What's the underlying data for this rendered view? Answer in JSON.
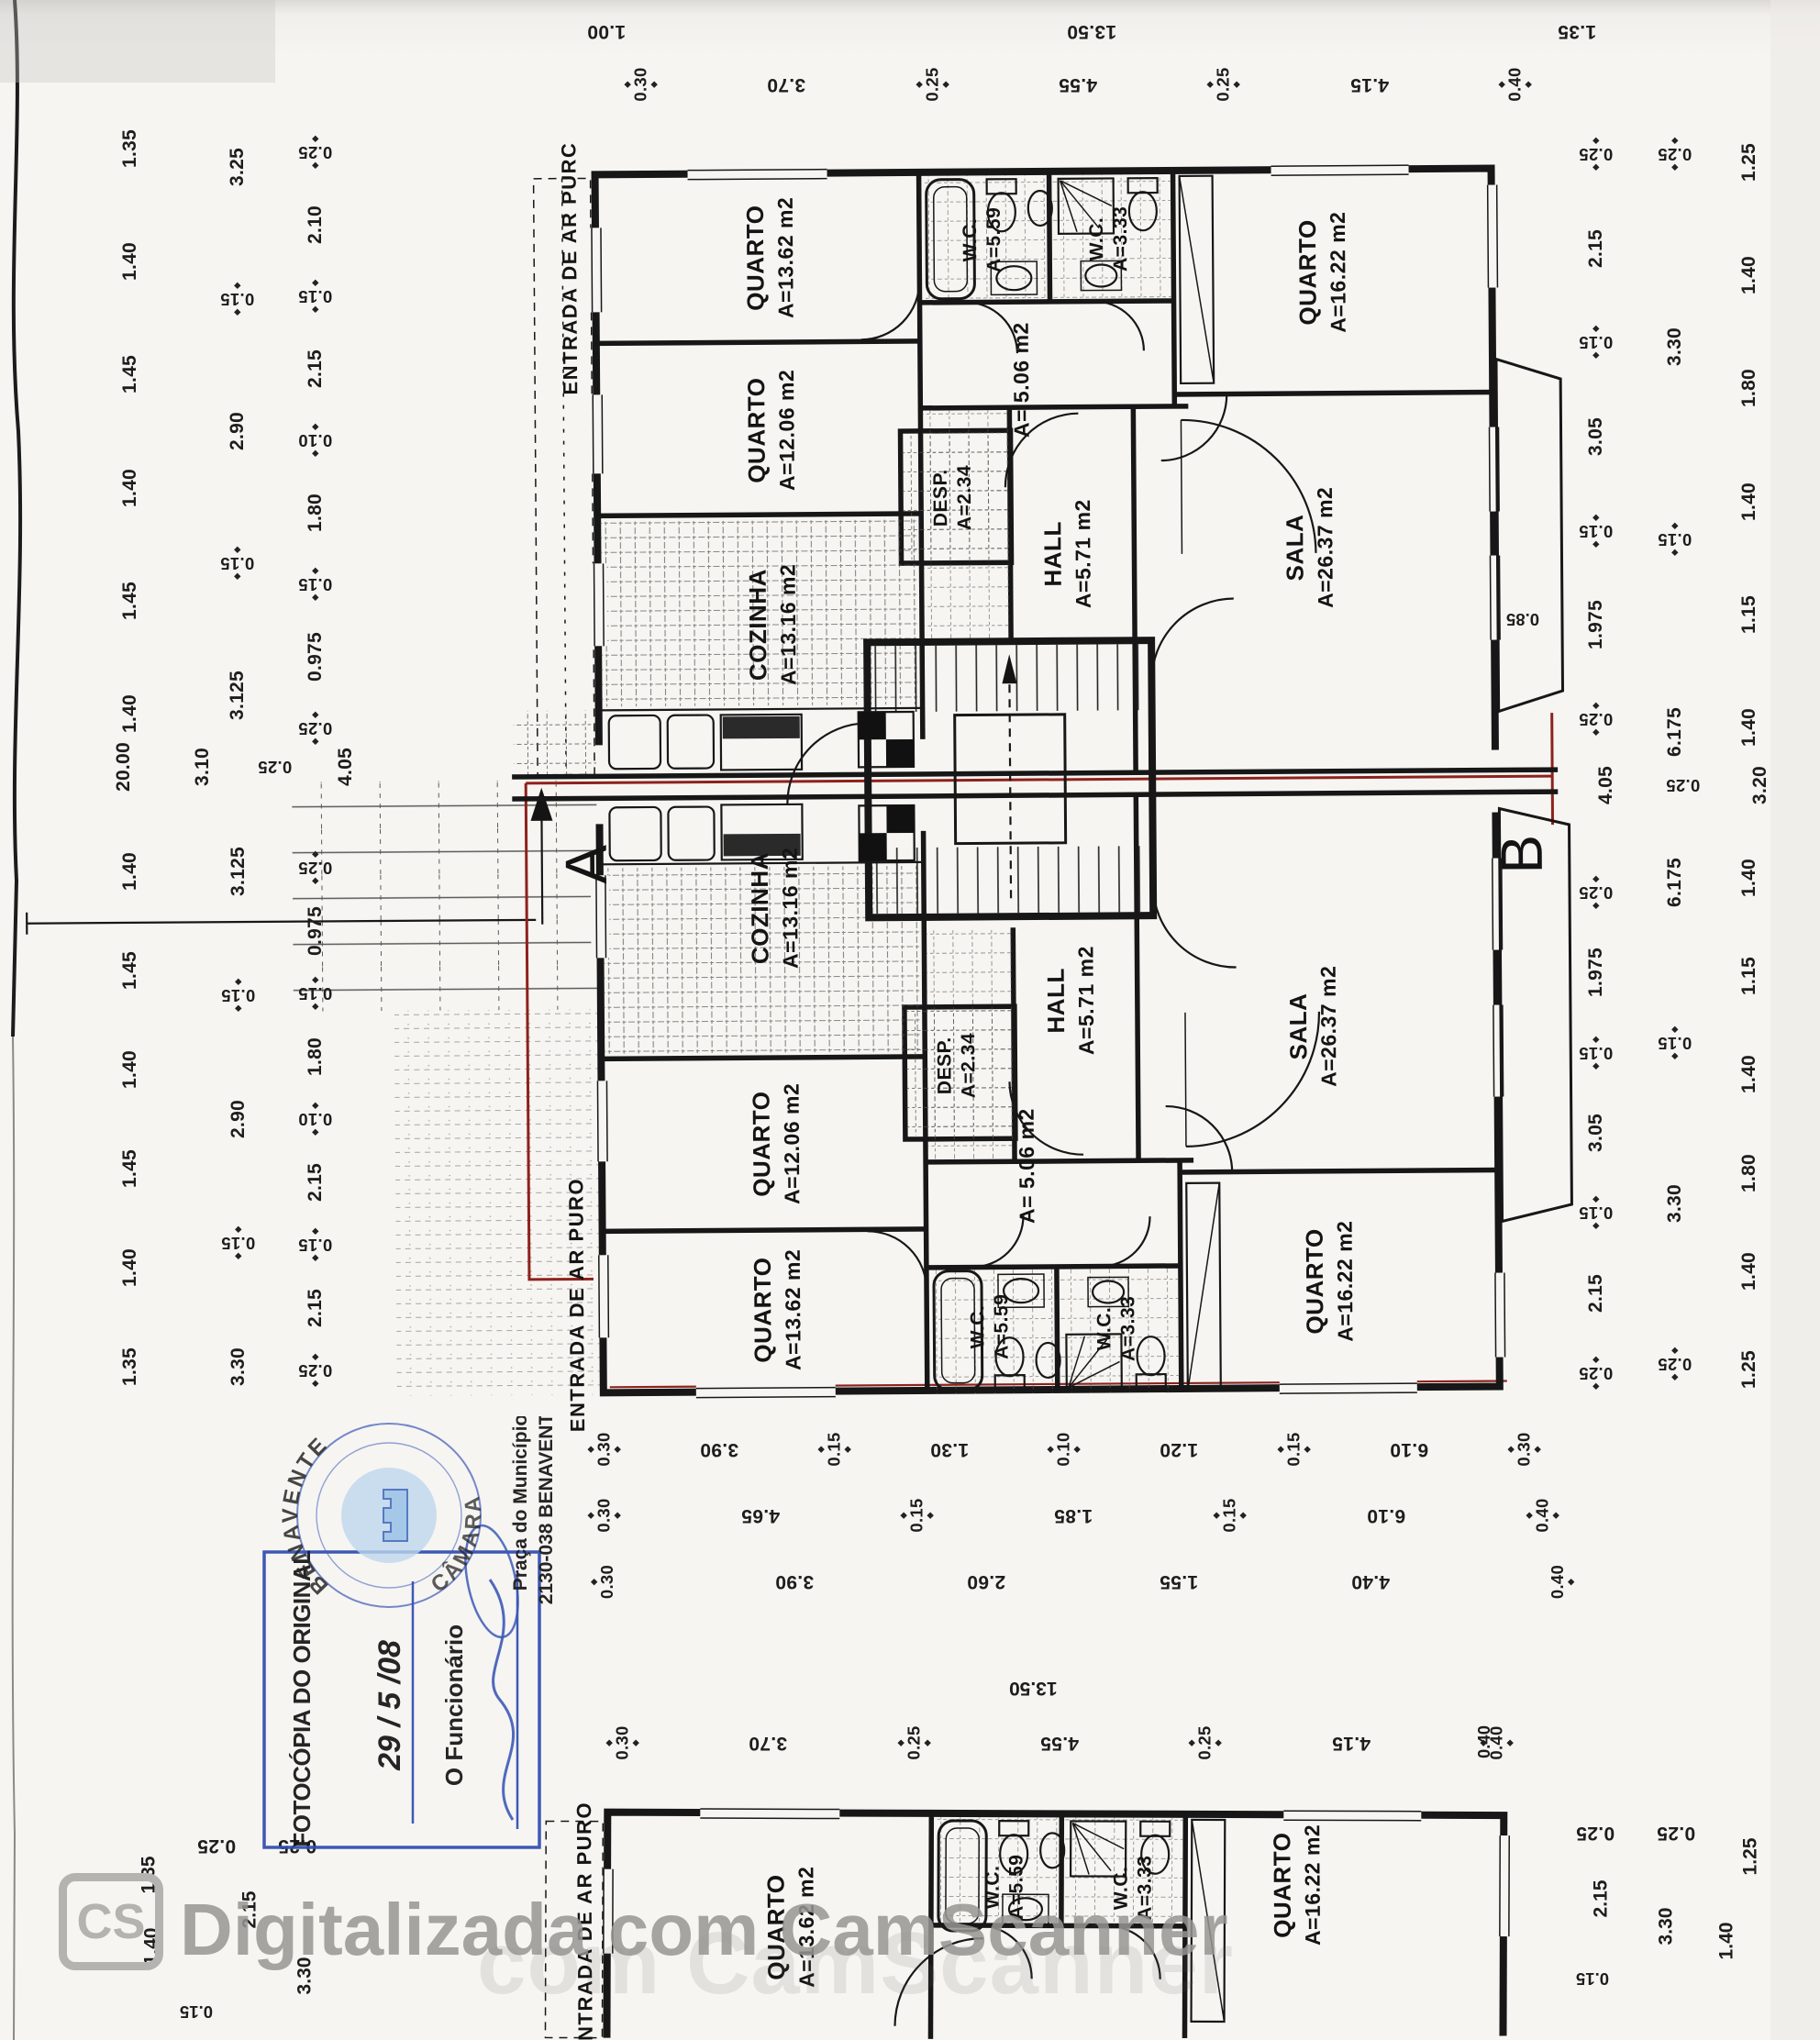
{
  "rooms": {
    "quarto1": {
      "name": "QUARTO",
      "area": "A=13.62 m2"
    },
    "quarto2": {
      "name": "QUARTO",
      "area": "A=12.06 m2"
    },
    "quarto3": {
      "name": "QUARTO",
      "area": "A=16.22 m2"
    },
    "sala": {
      "name": "SALA",
      "area": "A=26.37 m2"
    },
    "hall": {
      "name": "HALL",
      "area": "A=5.71 m2"
    },
    "cozinha": {
      "name": "COZINHA",
      "area": "A=13.16 m2"
    },
    "desp": {
      "name": "DESP.",
      "area": "A=2.34"
    },
    "wc1": {
      "name": "W.C.",
      "area": "A=5.59"
    },
    "wc2": {
      "name": "W.C.",
      "area": "A=3.33"
    },
    "corridor": {
      "area": "A= 5.06 m2"
    }
  },
  "entrada": {
    "top": "ENTRADA DE AR PURC",
    "bottom": "ENTRADA DE AR PURO",
    "partial": "ENTRADA DE AR PURO"
  },
  "markers": {
    "a": "A",
    "b": "B"
  },
  "dims": {
    "t1": [
      "1.00",
      "13.50",
      "1.35"
    ],
    "t2": [
      "0.30",
      "3.70",
      "0.25",
      "4.55",
      "0.25",
      "4.15",
      "0.40"
    ],
    "left_outer": [
      "1.35",
      "1.40",
      "1.45",
      "1.40",
      "1.45",
      "1.40"
    ],
    "left_mid": [
      "3.25",
      "0.15",
      "2.90",
      "0.15",
      "3.125"
    ],
    "left_inner": [
      "0.25",
      "2.10",
      "0.15",
      "2.15",
      "0.10",
      "1.80",
      "0.15",
      "0.975",
      "0.25"
    ],
    "left_header": [
      "20.00",
      "3.10",
      "0.25",
      "4.05"
    ],
    "left_outer2": [
      "1.40",
      "1.45",
      "1.40",
      "1.45",
      "1.40",
      "1.35"
    ],
    "left_mid2": [
      "3.125",
      "0.15",
      "2.90",
      "0.15",
      "3.30"
    ],
    "left_inner2": [
      "0.25",
      "0.975",
      "0.15",
      "1.80",
      "0.10",
      "2.15",
      "0.15",
      "2.15",
      "0.25"
    ],
    "right_inner": [
      "0.25",
      "2.15",
      "0.15",
      "3.05",
      "0.15",
      "1.975",
      "0.25"
    ],
    "right_mid": [
      "0.25",
      "3.30",
      "0.15",
      "6.175"
    ],
    "right_outer": [
      "1.25",
      "1.40",
      "1.80",
      "1.40",
      "1.15",
      "1.40"
    ],
    "right_header": [
      "4.05",
      "0.25",
      "3.20"
    ],
    "right_inner2": [
      "0.25",
      "1.975",
      "0.15",
      "3.05",
      "0.15",
      "2.15",
      "0.25"
    ],
    "right_mid2": [
      "6.175",
      "0.15",
      "3.30",
      "0.25"
    ],
    "right_outer2": [
      "1.40",
      "1.15",
      "1.40",
      "1.80",
      "1.40",
      "1.25"
    ],
    "b1": [
      "0.30",
      "3.90",
      "0.15",
      "1.30",
      "0.10",
      "1.20",
      "0.15",
      "6.10",
      "0.30"
    ],
    "b2": [
      "0.30",
      "4.65",
      "0.15",
      "1.85",
      "0.15",
      "6.10",
      "0.40"
    ],
    "b3": [
      "0.30",
      "3.90",
      "2.60",
      "1.55",
      "4.40",
      "0.40"
    ],
    "b4": "13.50",
    "b5": [
      "0.30",
      "3.70",
      "0.25",
      "4.55",
      "0.25",
      "4.15",
      "0.40"
    ],
    "balcony": "0.85",
    "frag040": "0.40",
    "bl_row": [
      "0.25",
      "0.25"
    ],
    "bl_col": [
      "1.35",
      "2.15",
      "1.40",
      "3.30",
      "0.15"
    ],
    "br_row": [
      "0.25",
      "0.25"
    ],
    "br_col": [
      "2.15",
      "3.30",
      "1.25",
      "1.40",
      "0.15"
    ]
  },
  "stamp": {
    "title": "FOTOCÓPIA DO ORIGINAL",
    "date": "29 / 5 /08",
    "official": "O Funcionário",
    "seal_top": "BENAVENTE",
    "seal_bottom": "CÂMARA",
    "address1": "Praça do Município",
    "address2": "2130-038 BENAVENTE",
    "color": "#2e4cb0"
  },
  "watermark": {
    "badge": "CS",
    "label": "Digitalizada com CamScanner",
    "echo": "com CamScanner"
  }
}
